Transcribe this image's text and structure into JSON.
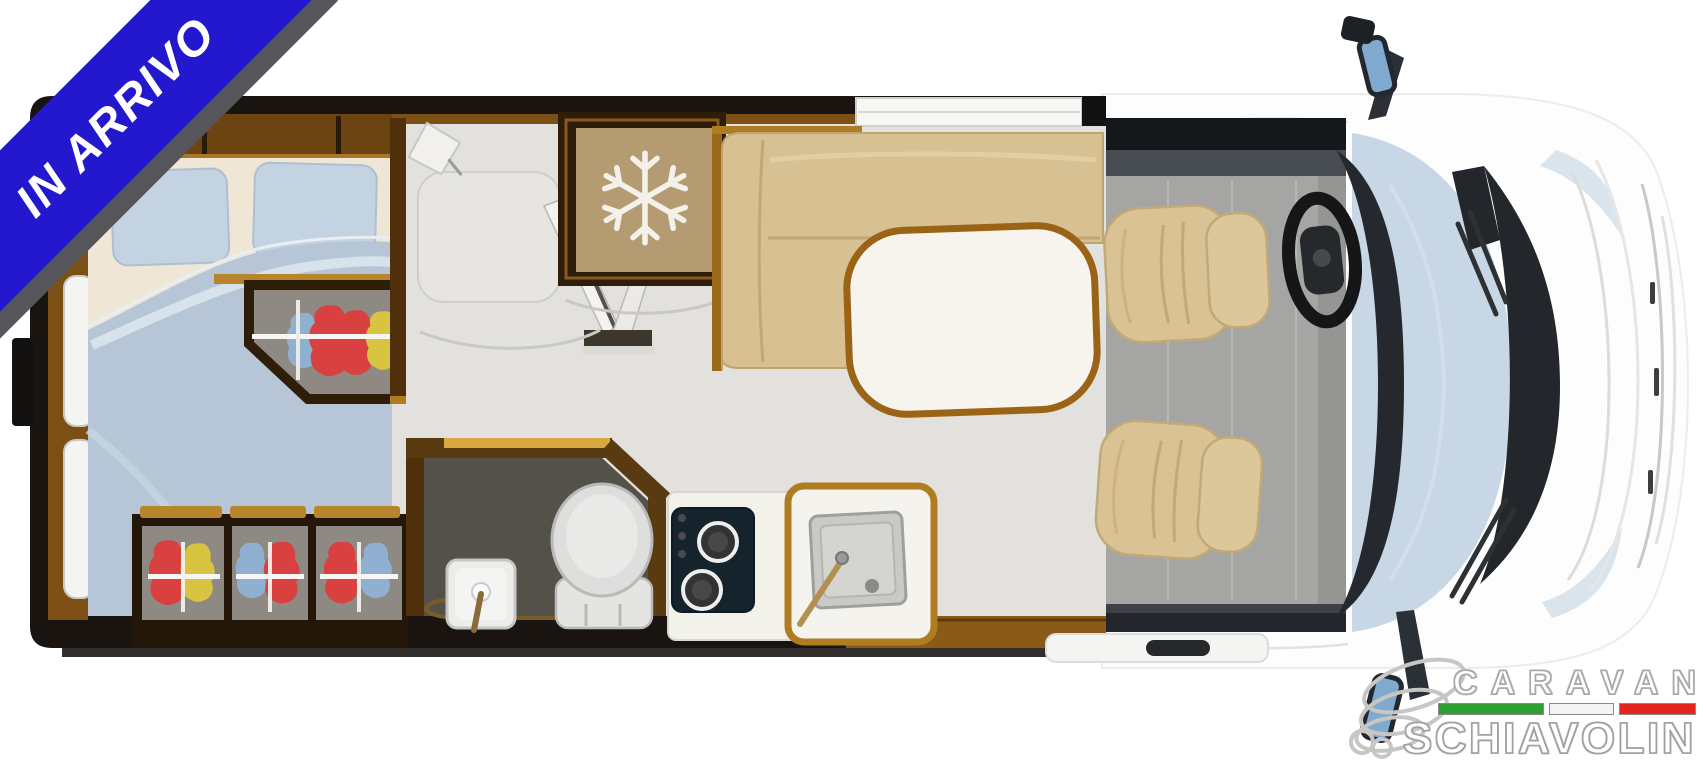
{
  "badge": {
    "label": "IN ARRIVO",
    "background_color": "#2318ce",
    "shadow_color": "#55555a",
    "text_color": "#ffffff"
  },
  "logo": {
    "line1": "CARAVAN",
    "line2": "SCHIAVOLIN",
    "flag_colors": [
      "#2f9e33",
      "#f4f4f4",
      "#e3251d"
    ],
    "text_color": "#ffffff",
    "outline_color": "#a8a8a8",
    "swirl_icon": "ribbon-swirl-icon"
  },
  "floorplan": {
    "type": "motorhome-top-view-layout",
    "zones": [
      "rear-double-bed",
      "pillows",
      "duvet",
      "mid-wardrobe-with-clothes",
      "rear-wardrobes-with-clothes",
      "entryway-with-open-door",
      "wall-lamp",
      "fridge-freezer",
      "freezer-snowflake-icon",
      "dinette-l-sofa",
      "dinette-table",
      "bathroom",
      "toilet",
      "washbasin",
      "kitchen-counter",
      "two-burner-stove",
      "kitchen-sink",
      "cab-floor",
      "driver-seat",
      "passenger-seat",
      "steering-wheel",
      "dashboard",
      "windshield",
      "hood",
      "side-mirror-top",
      "side-mirror-bottom",
      "entry-step",
      "left-wall-windows",
      "top-window"
    ],
    "palette": {
      "wall": "#191410",
      "wood_trim": "#7c5014",
      "gold_trim": "#b9852c",
      "floor": "#e2e1dd",
      "duvet_blue": "#b6c6d6",
      "pillow_blue": "#c4d3e2",
      "mattress_cream": "#efe6d6",
      "sofa_beige": "#d7c193",
      "seat_beige": "#d9c395",
      "table_white": "#f6f4ed",
      "fridge_tan": "#b59b72",
      "bathroom_floor": "#54504a",
      "stove_navy": "#15232d",
      "cab_floor_gray": "#a5a5a3",
      "windshield_blue": "#c8d7e5",
      "clothes_red": "#d94040",
      "clothes_yellow": "#d8c440",
      "clothes_blue": "#8fb0d0"
    }
  }
}
